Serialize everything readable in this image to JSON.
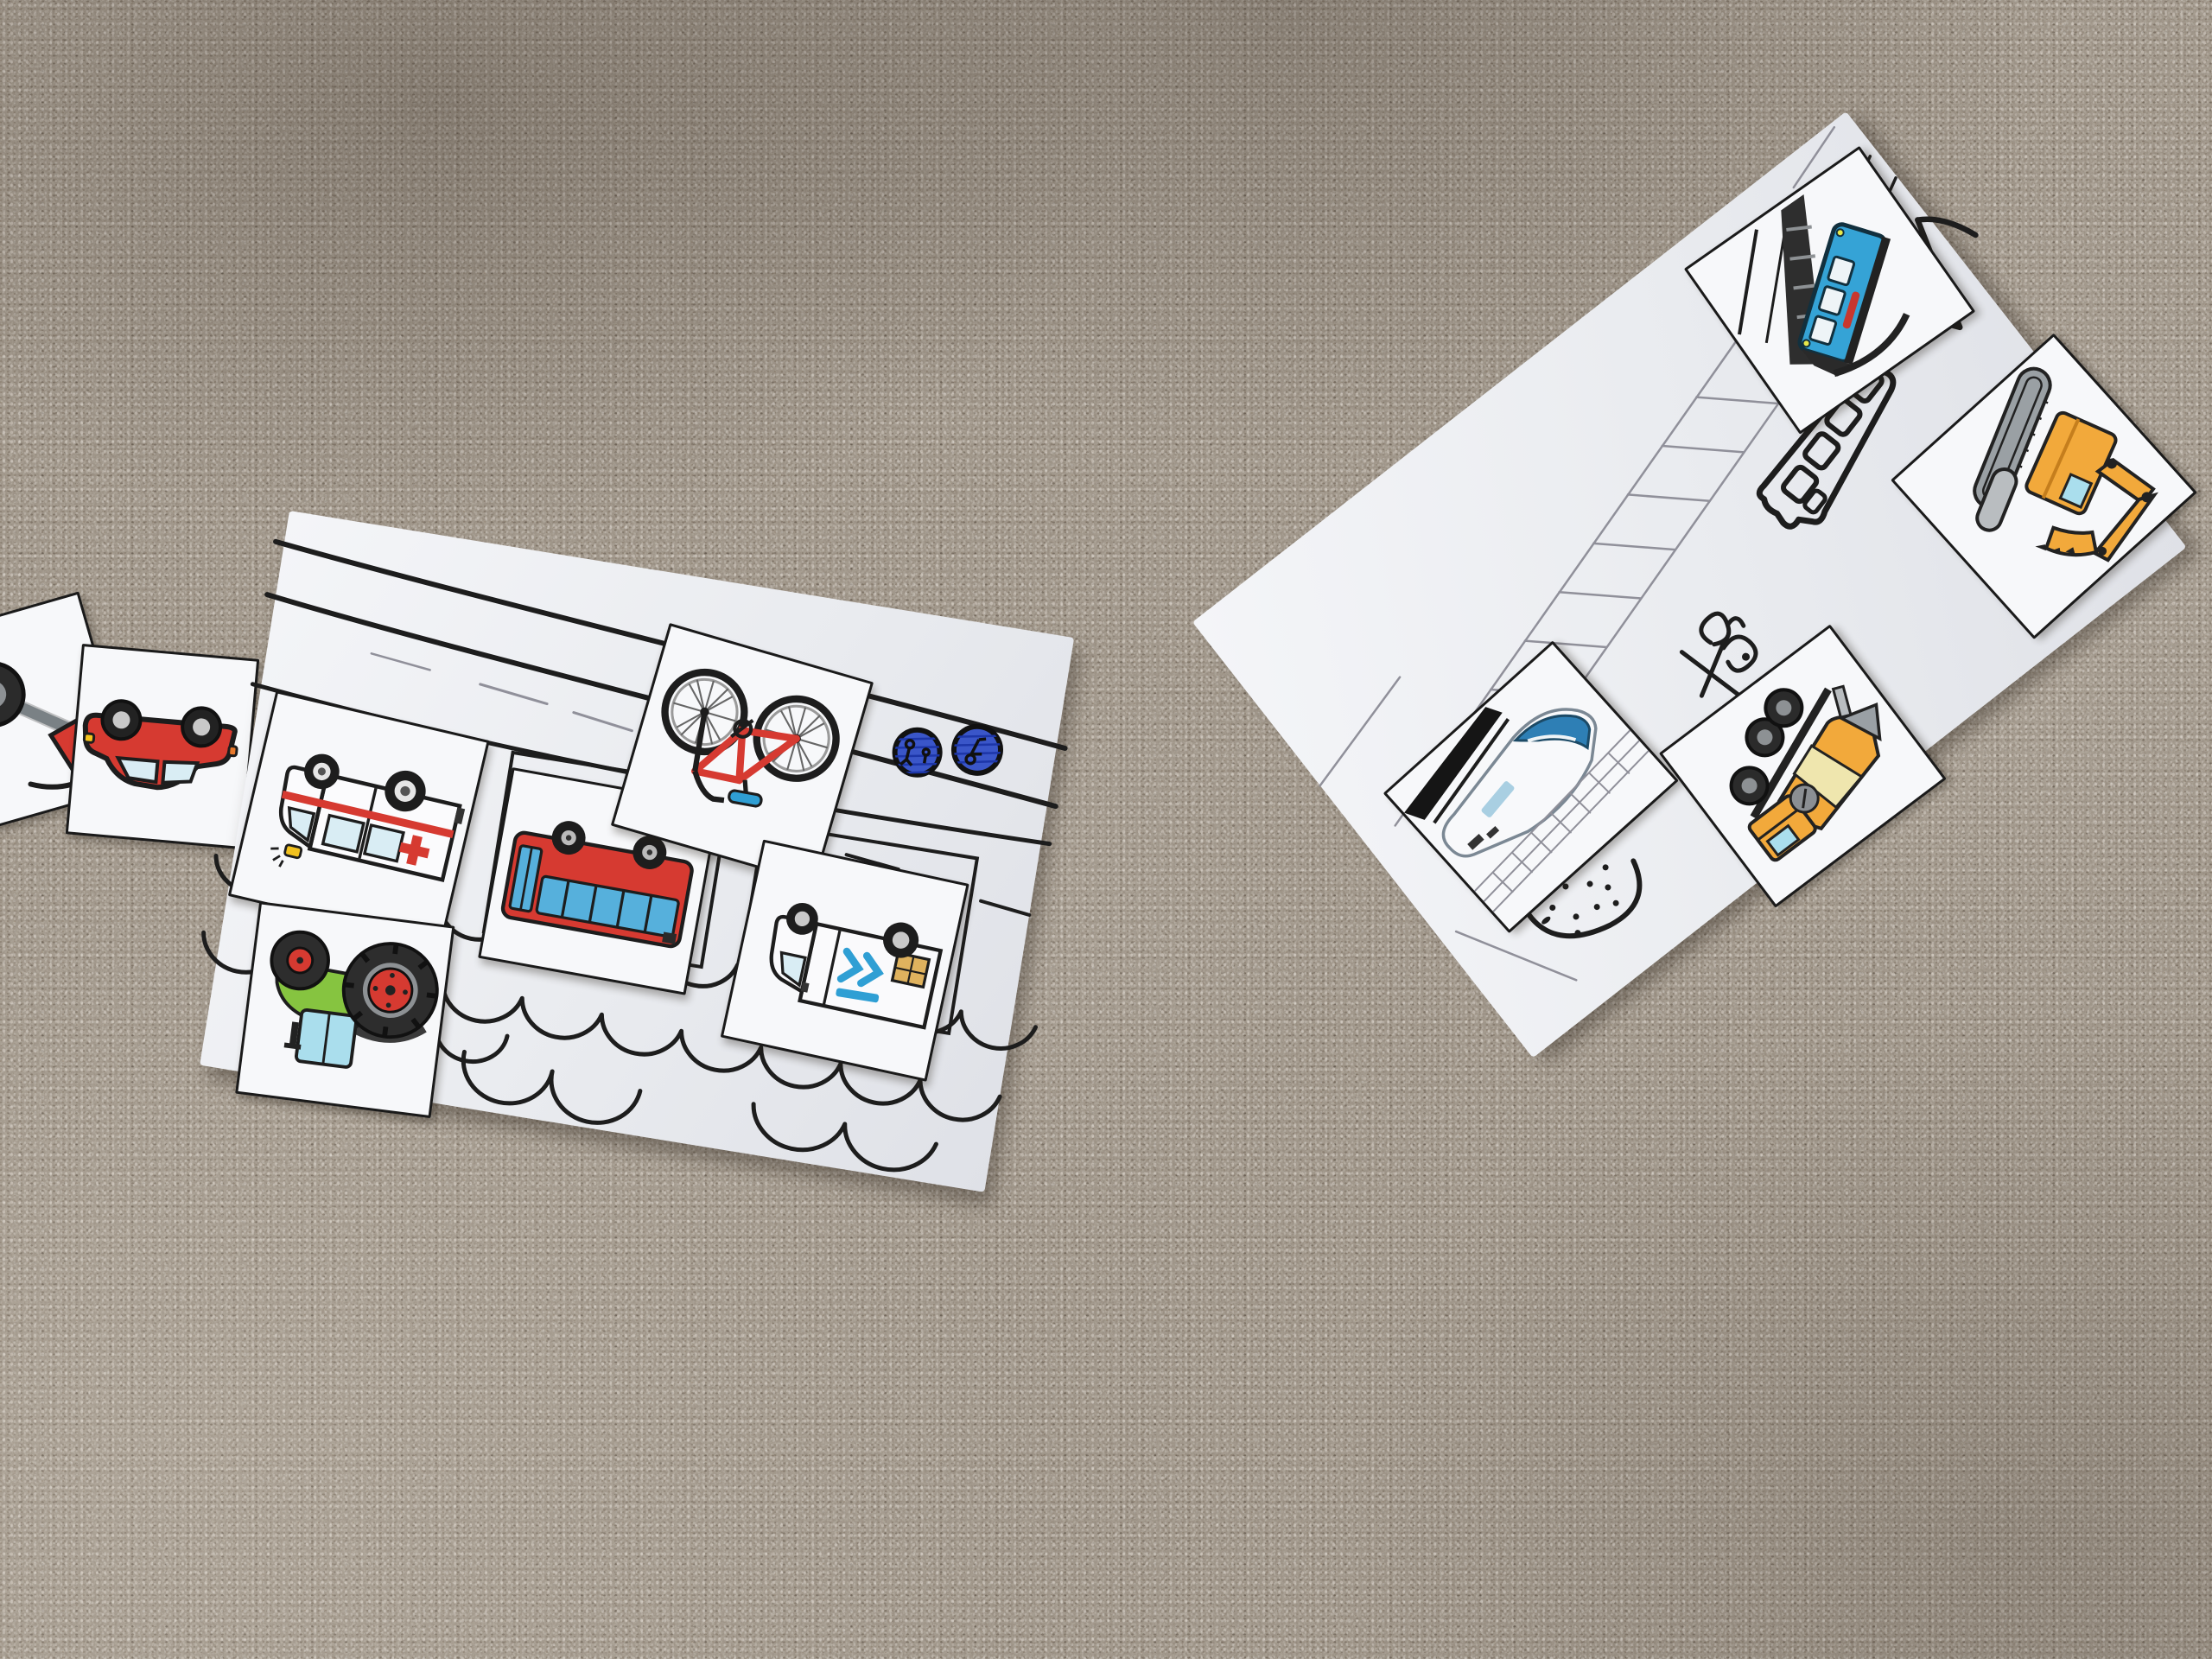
{
  "scene": {
    "description": "Photo of two hand-drawn vehicle worksheets lying on a beige carpet; laminated vehicle picture cards are placed on them, each vehicle upside-down",
    "surface": "speckled cut-pile carpet"
  },
  "colors": {
    "carpet_base": "#93887b",
    "card_white": "#f7f8fa",
    "ink_black": "#1d1d1d",
    "pencil_gray": "#90909a",
    "pen_blue": "#3a56c9",
    "pen_blue_dark": "#1d36a8",
    "red": "#d63a31",
    "window_pale": "#d9edf4",
    "window_blue": "#56b0dc",
    "bike_blue": "#2f9fd4",
    "green": "#86c440",
    "cab_blue": "#aadeed",
    "orange": "#f2a93b",
    "drum_cream": "#efe6ae",
    "package_tan": "#dfb25e",
    "metal_gray": "#9aa0a5",
    "tire_dark": "#2b2b2b",
    "funicular_blue": "#35a3d6",
    "train_blue": "#2e7fb5"
  },
  "loose_cards": [
    {
      "id": "partial-vehicle-card",
      "vehicle": "vehicle card cut off at image edge",
      "orientation": "upside-down"
    },
    {
      "id": "red-car-card",
      "vehicle": "red car",
      "orientation": "upside-down"
    }
  ],
  "left_sheet": {
    "id": "road-and-water-worksheet",
    "drawn_elements": [
      "curved road lines",
      "pencil dashes",
      "two blue round sign doodles",
      "empty card outline rectangles",
      "short black dashes",
      "rows of water waves"
    ],
    "cards": [
      {
        "id": "ambulance-card",
        "vehicle": "white ambulance with red stripe and red cross",
        "orientation": "upside-down"
      },
      {
        "id": "bus-card",
        "vehicle": "red city bus with blue windows",
        "orientation": "upside-down"
      },
      {
        "id": "bicycle-card",
        "vehicle": "red bicycle with blue saddle",
        "orientation": "upside-down"
      },
      {
        "id": "delivery-van-card",
        "vehicle": "white delivery van with blue chevrons and package",
        "orientation": "upside-down"
      },
      {
        "id": "tractor-card",
        "vehicle": "green tractor with red wheel hubs",
        "orientation": "upside-down"
      }
    ]
  },
  "right_sheet": {
    "id": "rails-and-construction-worksheet",
    "drawn_elements": [
      "pencil ladder track",
      "black marker steep rail",
      "black marker bus doodle with windows",
      "large check doodle",
      "handwritten scribble",
      "dotted mound",
      "pencil corner lines"
    ],
    "cards": [
      {
        "id": "funicular-card",
        "vehicle": "blue funicular cabin on steep rail",
        "orientation": "upside-down"
      },
      {
        "id": "train-card",
        "vehicle": "white high-speed train on drawn track",
        "orientation": "upside-down"
      },
      {
        "id": "cement-mixer-card",
        "vehicle": "orange cement mixer truck",
        "orientation": "upside-down"
      },
      {
        "id": "excavator-card",
        "vehicle": "orange tracked excavator",
        "orientation": "upside-down"
      }
    ]
  }
}
